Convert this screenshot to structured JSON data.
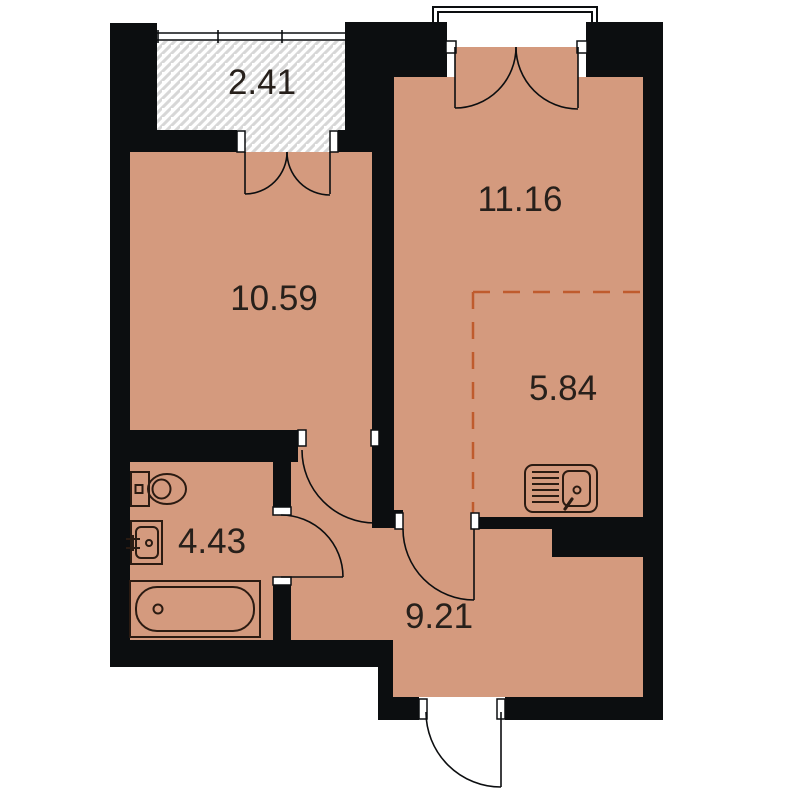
{
  "plan": {
    "type": "floor-plan",
    "rooms": [
      {
        "name": "balcony",
        "area": "2.41"
      },
      {
        "name": "living-room",
        "area": "11.16"
      },
      {
        "name": "bedroom",
        "area": "10.59"
      },
      {
        "name": "kitchen-zone",
        "area": "5.84"
      },
      {
        "name": "bathroom",
        "area": "4.43"
      },
      {
        "name": "hallway",
        "area": "9.21"
      }
    ],
    "colors": {
      "floor": "#d49a7e",
      "wall": "#0c0e10",
      "fixline": "#2b1b12",
      "label": "#27201b",
      "dash": "#bf5b2d",
      "hatch": "#d7d7d7"
    },
    "icons": [
      "toilet-icon",
      "bathroom-sink-icon",
      "bathtub-icon",
      "kitchen-sink-icon"
    ]
  }
}
